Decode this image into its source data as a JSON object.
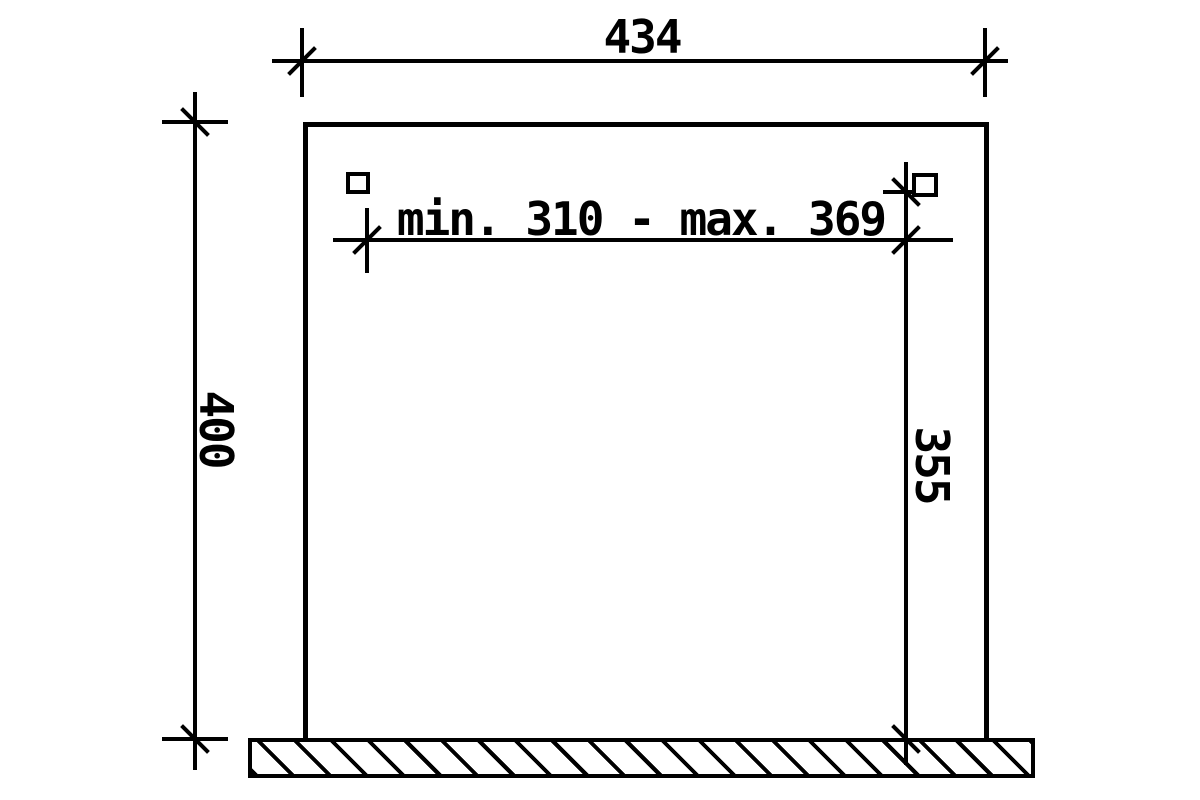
{
  "drawing": {
    "background_color": "#ffffff",
    "line_color": "#000000",
    "dimensions": {
      "overall_width": "434",
      "overall_height": "400",
      "clear_span": "min. 310 - max. 369",
      "inner_height": "355"
    }
  }
}
